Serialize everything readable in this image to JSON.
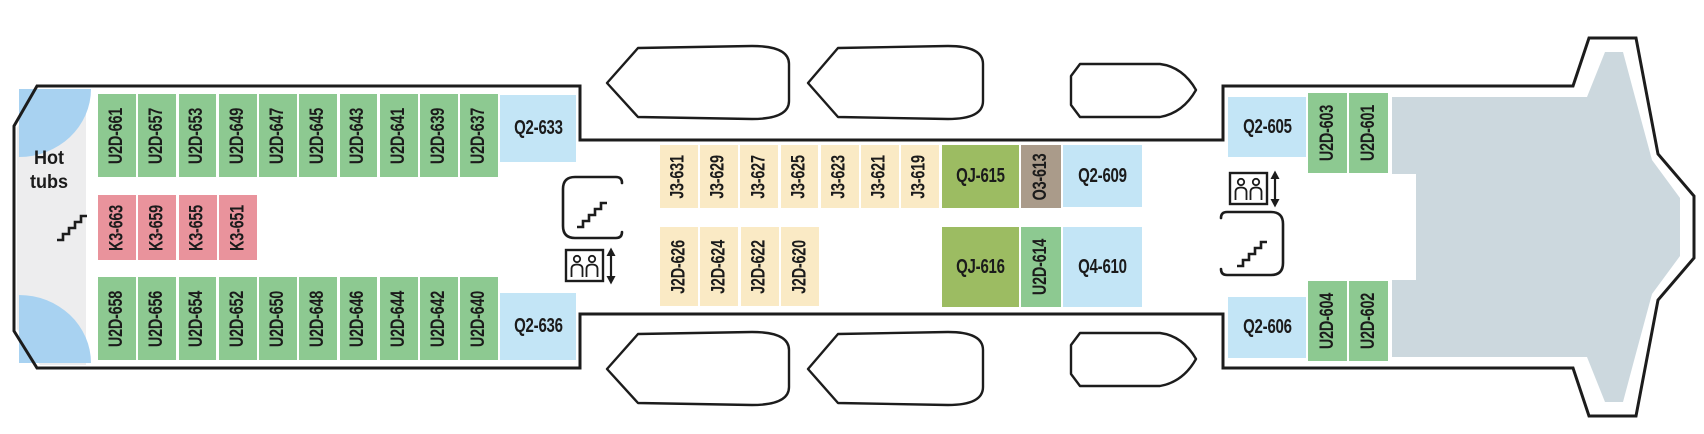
{
  "deck_plan": {
    "hot_tubs_label": "Hot tubs",
    "rows": {
      "port_aft": [
        "U2D-661",
        "U2D-657",
        "U2D-653",
        "U2D-649",
        "U2D-647",
        "U2D-645",
        "U2D-643",
        "U2D-641",
        "U2D-639",
        "U2D-637"
      ],
      "k3": [
        "K3-663",
        "K3-659",
        "K3-655",
        "K3-651"
      ],
      "starboard_aft": [
        "U2D-658",
        "U2D-656",
        "U2D-654",
        "U2D-652",
        "U2D-650",
        "U2D-648",
        "U2D-646",
        "U2D-644",
        "U2D-642",
        "U2D-640"
      ],
      "mid_port": [
        "J3-631",
        "J3-629",
        "J3-627",
        "J3-625",
        "J3-623",
        "J3-621",
        "J3-619"
      ],
      "mid_starboard": [
        "J2D-626",
        "J2D-624",
        "J2D-622",
        "J2D-620"
      ]
    },
    "single_cabins": {
      "q2_633": "Q2-633",
      "q2_636": "Q2-636",
      "qj_615": "QJ-615",
      "o3_613": "O3-613",
      "q2_609": "Q2-609",
      "qj_616": "QJ-616",
      "u2d_614": "U2D-614",
      "q4_610": "Q4-610",
      "q2_605": "Q2-605",
      "u2d_603": "U2D-603",
      "u2d_601": "U2D-601",
      "q2_606": "Q2-606",
      "u2d_604": "U2D-604",
      "u2d_602": "U2D-602"
    },
    "colors": {
      "cabin_green": "#8dc991",
      "cabin_pink": "#e9939c",
      "cabin_blue": "#c3e5f6",
      "cabin_cream": "#faeac5",
      "cabin_olive": "#9cbc62",
      "cabin_taupe": "#aa9b8a",
      "deck_gray": "#ccd8de",
      "stern_gray": "#ededee",
      "hot_tub_blue": "#a8d2f1",
      "outline_black": "#1c1c1c"
    }
  }
}
